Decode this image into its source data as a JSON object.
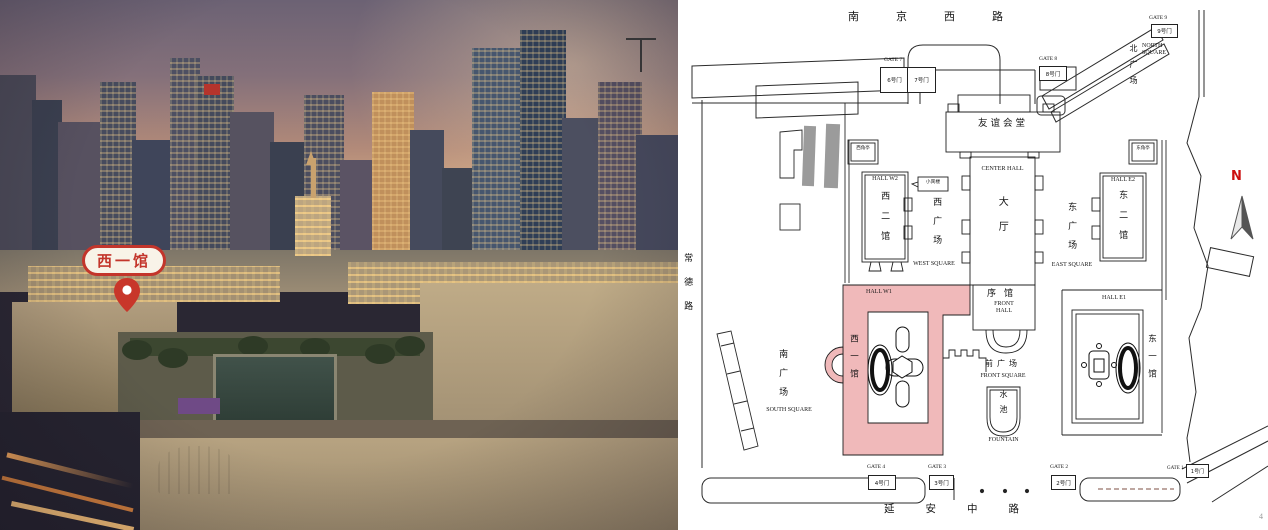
{
  "photo": {
    "marker_label": "西一馆"
  },
  "plan": {
    "streets": {
      "north": "南京西路",
      "west": "常德路",
      "south": "延安中路"
    },
    "squares": {
      "north_zh": "北广场",
      "north_en": "NORTH SQUARE",
      "west_zh": "西广场",
      "west_en": "WEST SQUARE",
      "east_zh": "东广场",
      "east_en": "EAST SQUARE",
      "south_zh": "南广场",
      "south_en": "SOUTH SQUARE",
      "front_zh": "前广场",
      "front_en": "FRONT SQUARE"
    },
    "halls": {
      "friendship": "友谊会堂",
      "center_en": "CENTER HALL",
      "center_zh": "大厅",
      "w2_en": "HALL W2",
      "w2_zh": "西二馆",
      "e2_en": "HALL E2",
      "e2_zh": "东二馆",
      "w1_en": "HALL W1",
      "w1_zh": "西一馆",
      "e1_en": "HALL E1",
      "e1_zh": "东一馆",
      "front_zh": "序馆",
      "front_en": "FRONT HALL",
      "fountain_zh": "水池",
      "fountain_en": "FOUNTAIN",
      "west_pavilion": "西角亭",
      "east_pavilion": "东角亭",
      "guest_house": "小宾楼"
    },
    "gates": {
      "g9_en": "GATE 9",
      "g9_zh": "9号门",
      "g8_en": "GATE 8",
      "g8_zh": "8号门",
      "g7_en": "GATE 7",
      "g7_zh_a": "6号门",
      "g7_zh_b": "7号门",
      "g4_en": "GATE 4",
      "g4_zh": "4号门",
      "g3_en": "GATE 3",
      "g3_zh": "3号门",
      "g2_en": "GATE 2",
      "g2_zh": "2号门",
      "g1_en": "GATE 1",
      "g1_zh": "1号门"
    },
    "compass": "N",
    "page_number": "4",
    "highlight_color": "#f0b9ba"
  }
}
